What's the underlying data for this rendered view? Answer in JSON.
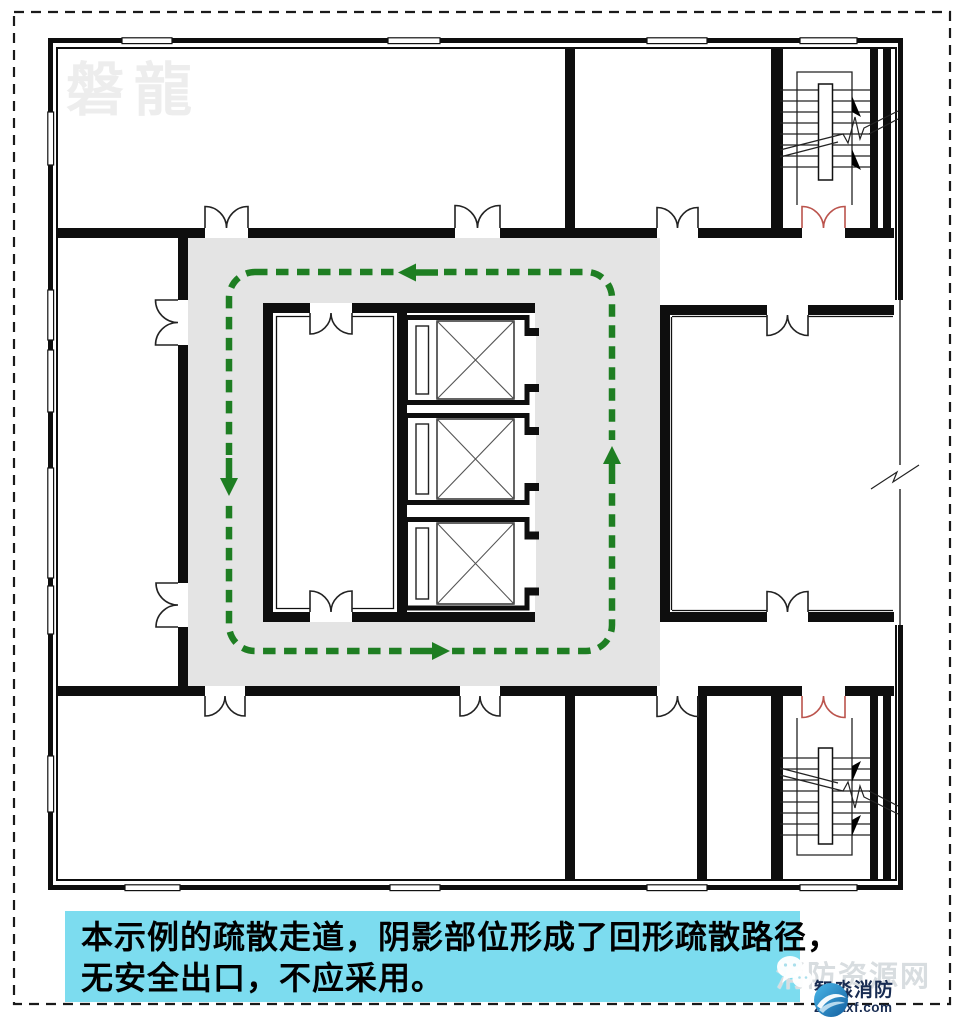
{
  "watermark_topleft": "磐龍",
  "caption": {
    "line1": "本示例的疏散走道，阴影部位形成了回形疏散路径，",
    "line2": "无安全出口，不应采用。"
  },
  "site_watermark": {
    "icon": "wechat-icon",
    "label": "消防资源网"
  },
  "brand": {
    "icon": "swoosh-logo-icon",
    "name": "智淼消防",
    "url": "zmjaxf.com"
  },
  "colors": {
    "route_green": "#1e7e22",
    "corridor_gray": "#e4e4e4",
    "stair_door_red": "#bb544d",
    "caption_bg": "#7cdcef",
    "brand_navy": "#182c52",
    "wall_black": "#0e0e0e"
  }
}
